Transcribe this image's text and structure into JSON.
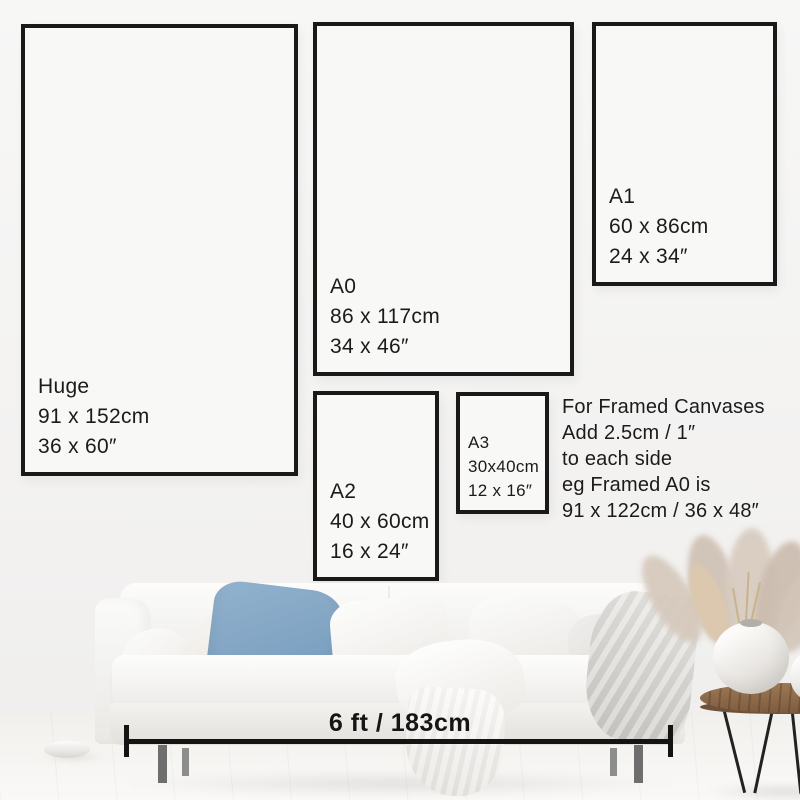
{
  "title": "Poster and canvas size guide",
  "frames": [
    {
      "name": "Huge",
      "cm": "91 x 152cm",
      "inches": "36 x 60″"
    },
    {
      "name": "A0",
      "cm": "86 x 117cm",
      "inches": "34 x 46″"
    },
    {
      "name": "A1",
      "cm": "60 x 86cm",
      "inches": "24 x 34″"
    },
    {
      "name": "A2",
      "cm": "40 x 60cm",
      "inches": "16 x 24″"
    },
    {
      "name": "A3",
      "cm": "30x40cm",
      "inches": "12 x 16″"
    }
  ],
  "framed_note": {
    "lines": [
      "For Framed Canvases",
      "Add 2.5cm / 1″",
      "to each side",
      "eg Framed A0 is",
      "91 x 122cm / 36 x 48″"
    ]
  },
  "measurement": {
    "label": "6 ft / 183cm"
  },
  "colors": {
    "frame_border": "#191919",
    "text": "#1b1b1b",
    "wall": "#f4f3f2",
    "blue_pillow": "#84a7c6",
    "table_wood": "#8a6a4e",
    "measure_line": "#141414"
  }
}
